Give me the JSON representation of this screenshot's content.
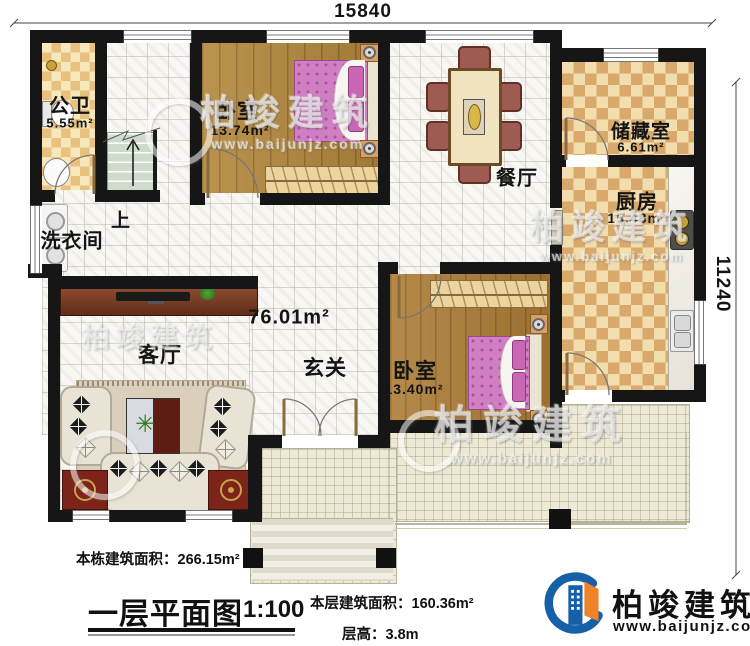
{
  "dimensions": {
    "width_mm": "15840",
    "height_mm": "11240"
  },
  "rooms": {
    "bathroom": {
      "name": "公卫",
      "area": "5.55m²"
    },
    "bedroom1": {
      "name": "卧室",
      "area": "13.74m²"
    },
    "dining": {
      "name": "餐厅"
    },
    "storage": {
      "name": "储藏室",
      "area": "6.61m²"
    },
    "kitchen": {
      "name": "厨房",
      "area": "15.48m²"
    },
    "laundry": {
      "name": "洗衣间"
    },
    "stairs": {
      "up_label": "上"
    },
    "hall": {
      "name": "玄关",
      "area": "76.01m²"
    },
    "living": {
      "name": "客厅"
    },
    "bedroom2": {
      "name": "卧室",
      "area": "13.40m²"
    }
  },
  "annotations": {
    "total_area": "本栋建筑面积：266.15m²",
    "title": "一层平面图",
    "scale": "1:100",
    "floor_area": "本层建筑面积：160.36m²",
    "floor_height": "层高：3.8m"
  },
  "brand": {
    "name": "柏竣建筑",
    "url": "www.baijunjz.com"
  },
  "watermark": {
    "name": "柏竣建筑",
    "url": "www.baijunjz.com"
  },
  "colors": {
    "wall": "#161616",
    "bed": "#d07fc2",
    "checker": "#d9a96b",
    "wood": "#b3873c",
    "terrace": "#ede9d6",
    "brand_blue": "#1660a8",
    "brand_orange": "#ef8329"
  }
}
